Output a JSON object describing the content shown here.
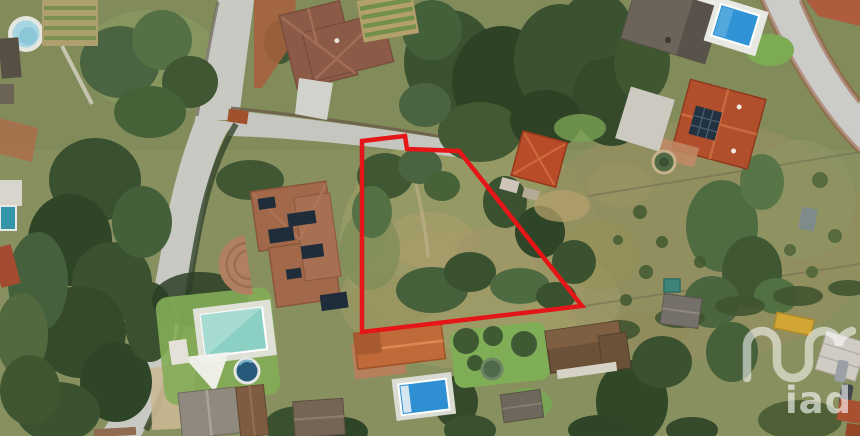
{
  "watermark": {
    "text": "iad",
    "color": "#ffffff",
    "opacity": 0.55
  },
  "plot_boundary": {
    "color": "#e41617",
    "stroke_width": 4.5,
    "points": "362,141 405,136 407,149 459,151 582,306 362,332"
  },
  "scene": {
    "kind": "aerial-satellite-photo",
    "palette": {
      "vegetation_base": "#87905e",
      "vegetation_dark": "#3b5230",
      "scrub_dry": "#a29a68",
      "road": "#c9c9c4",
      "roof_terracotta": "#b14e2c",
      "roof_brown": "#8c5b47",
      "pool_blue": "#2f93d6",
      "pool_teal": "#8ccfc5",
      "solar_panel": "#1f2d3a"
    }
  }
}
